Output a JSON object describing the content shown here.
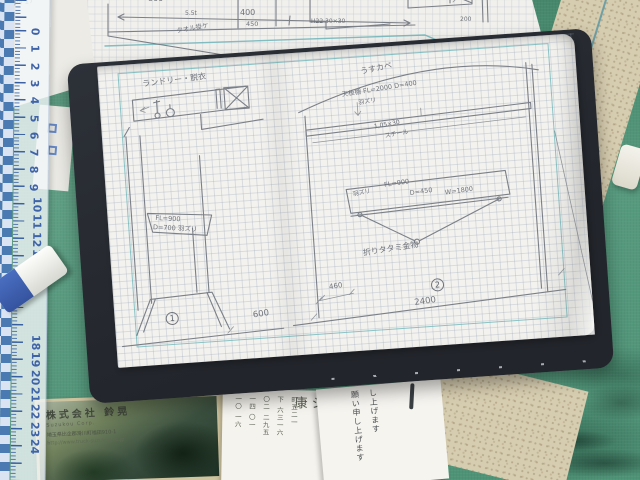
{
  "ruler": {
    "numbers_upper": [
      "0",
      "1",
      "2",
      "3",
      "4",
      "5",
      "6",
      "7",
      "8",
      "9",
      "10",
      "11",
      "12",
      "13",
      "14"
    ],
    "numbers_lower": [
      "18",
      "19",
      "20",
      "21",
      "22",
      "23",
      "24"
    ]
  },
  "desk_papers": {
    "corner_note": "P4 17",
    "letter_columns": [
      "し上げます",
      "願い申し上げます"
    ],
    "address_paper": {
      "heading": "康シ",
      "columns": [
        "町五二一",
        "下 六三一六",
        "〇二 二九五",
        "一四 〇一",
        "一〇 一六"
      ]
    }
  },
  "business_card": {
    "company": "株式会社 鈴晃",
    "company_en": "Suzukou Corp.",
    "address": "埼玉県比企郡滑川町福田910-1",
    "url": "http://www.truck-suzukou.co.jp"
  },
  "previous_page": {
    "dim_800": "800",
    "dim_400": "400",
    "thickness": "5.5t",
    "towel_label": "タオル掛ケ",
    "dim_450": "450",
    "note_h22": "H22 30×30",
    "dim_200": "200"
  },
  "sketch_left": {
    "title": "ランドリー・脱衣",
    "level": "FL=900",
    "depth": "D=700 羽ズリ",
    "number": "1",
    "dim_600": "600"
  },
  "sketch_right": {
    "wall_label": "うすカベ",
    "shelf_label": "天板棚 FL=2000 D=400",
    "shelf_note": "羽ズリ",
    "bracket_size": "1,05×30",
    "bracket_material": "スチール",
    "table_note": "羽ズリ",
    "table_level": "FL=900",
    "table_depth": "D=450",
    "table_width": "W=1800",
    "hardware_label": "折りタタミ金物",
    "number": "2",
    "dim_2400": "2400",
    "dim_460": "460"
  }
}
